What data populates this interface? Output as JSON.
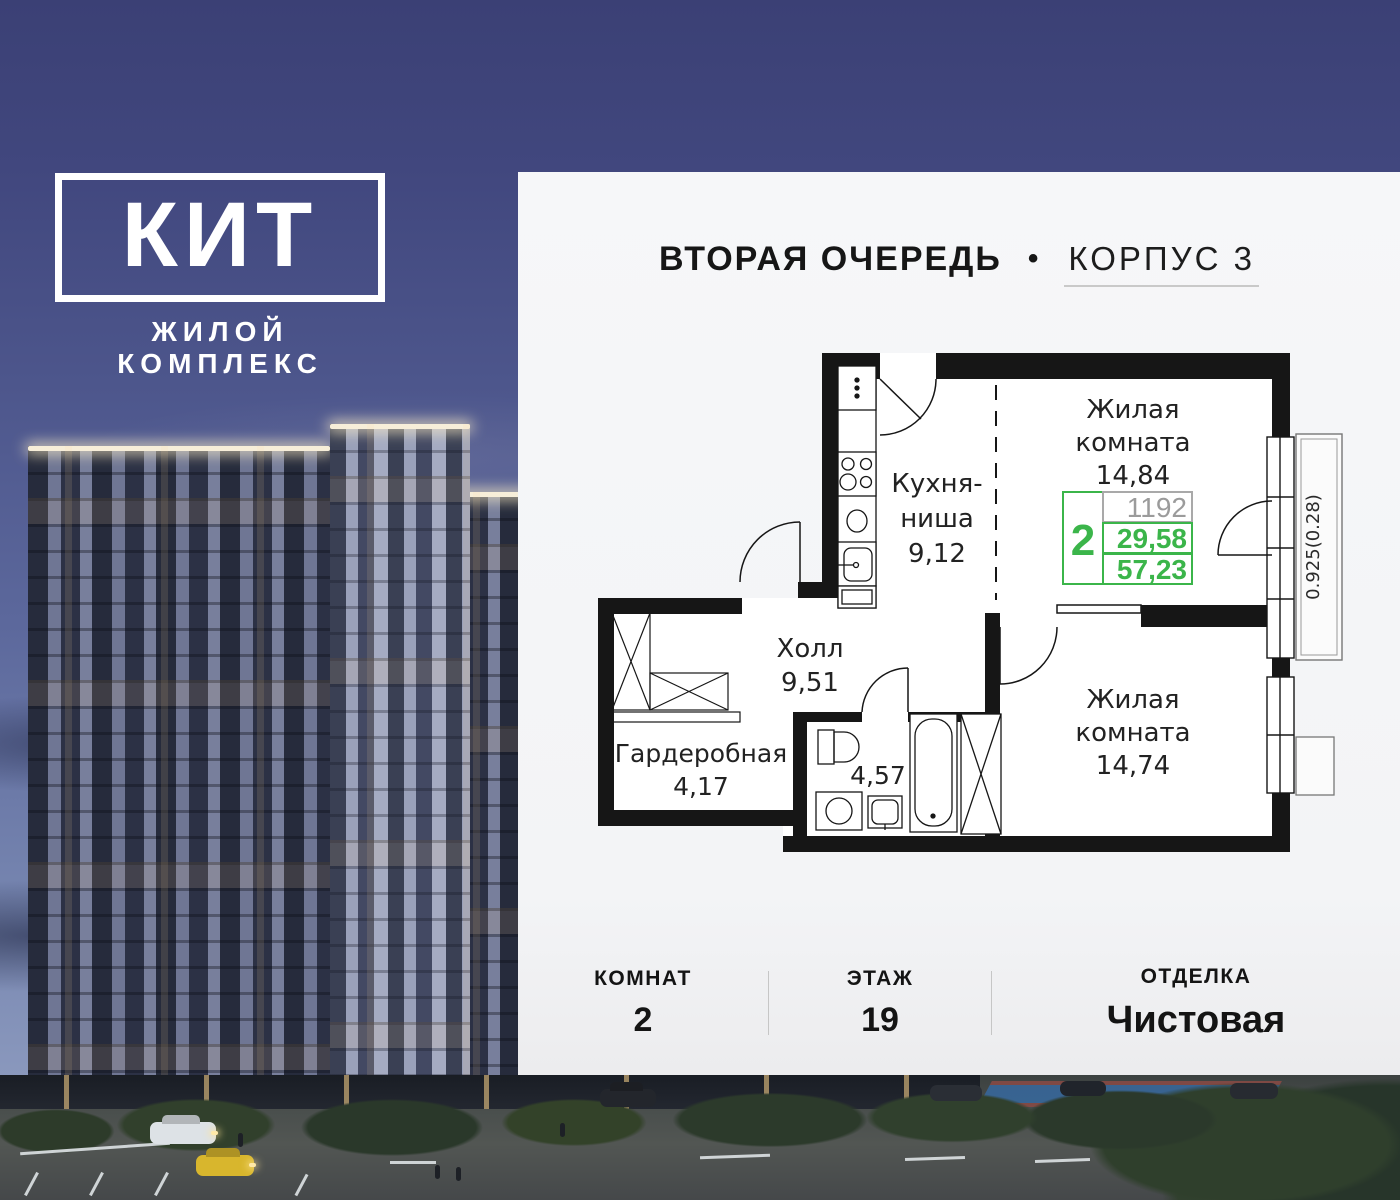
{
  "logo": {
    "title": "КИТ",
    "subtitle": "ЖИЛОЙ КОМПЛЕКС"
  },
  "header": {
    "phase": "ВТОРАЯ ОЧЕРЕДЬ",
    "bullet": "•",
    "building": "КОРПУС 3"
  },
  "floor_plan": {
    "living_room_1": {
      "name_line1": "Жилая",
      "name_line2": "комната",
      "area": "14,84"
    },
    "kitchen": {
      "name_line1": "Кухня-",
      "name_line2": "ниша",
      "area": "9,12"
    },
    "hall": {
      "name": "Холл",
      "area": "9,51"
    },
    "wardrobe": {
      "name": "Гардеробная",
      "area": "4,17"
    },
    "bathroom": {
      "area": "4,57"
    },
    "living_room_2": {
      "name_line1": "Жилая",
      "name_line2": "комната",
      "area": "14,74"
    },
    "balcony_dimension": "0.925(0.28)",
    "stats": {
      "rooms": "2",
      "unit_number": "1192",
      "living_area": "29,58",
      "total_area": "57,23"
    },
    "colors": {
      "accent_green": "#3bb54a",
      "number_gray": "#9b9b9b",
      "wall_black": "#161616"
    }
  },
  "info_bar": {
    "items": [
      {
        "label": "КОМНАТ",
        "value": "2"
      },
      {
        "label": "ЭТАЖ",
        "value": "19"
      },
      {
        "label": "ОТДЕЛКА",
        "value": "Чистовая"
      }
    ]
  }
}
